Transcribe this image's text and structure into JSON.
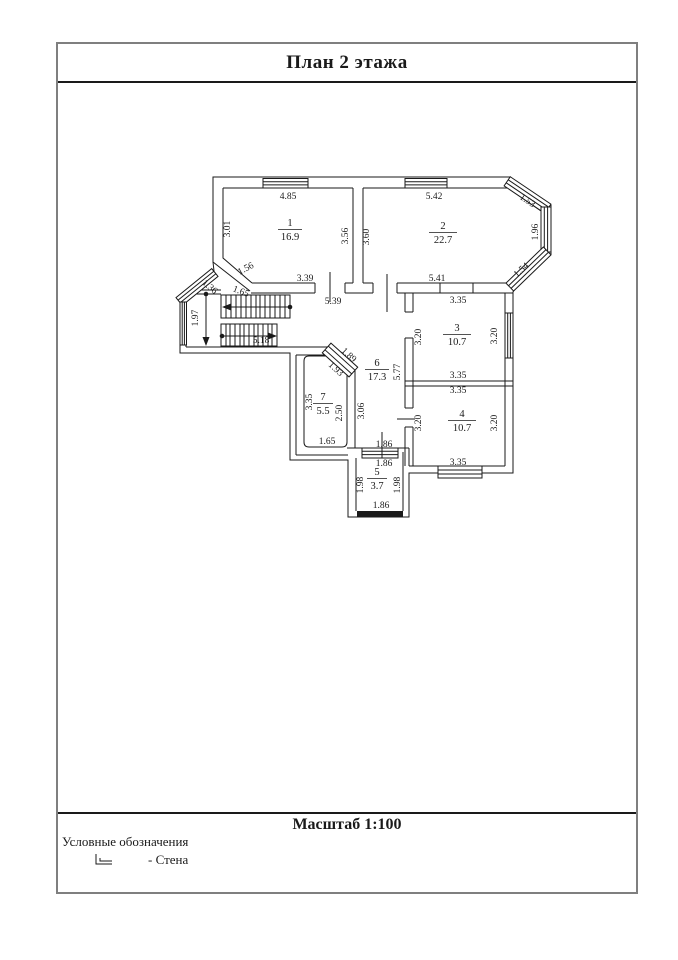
{
  "page": {
    "title": "План 2 этажа",
    "scale_label": "Масштаб 1:100",
    "legend_title": "Условные обозначения",
    "legend_wall_label": "- Стена",
    "wall_symbol_icon": "wall-corner-icon",
    "line_color": "#1a1a1a",
    "frame_color": "#7f7f7f"
  },
  "plan": {
    "rooms": [
      {
        "number": "1",
        "area": "16.9"
      },
      {
        "number": "2",
        "area": "22.7"
      },
      {
        "number": "3",
        "area": "10.7"
      },
      {
        "number": "4",
        "area": "10.7"
      },
      {
        "number": "5",
        "area": "3.7"
      },
      {
        "number": "6",
        "area": "17.3"
      },
      {
        "number": "7",
        "area": "5.5"
      }
    ],
    "dims": {
      "r1_top": "4.85",
      "r1_left": "3.01",
      "r1_right": "3.56",
      "r1_diag": "1.56",
      "r1_bottom": "3.39",
      "r2_top": "5.42",
      "r2_left": "3.60",
      "bay_top": "1.53",
      "bay_right": "1.96",
      "bay_bottom": "1.54",
      "r2_bottom": "5.41",
      "hall_top": "5.39",
      "stair_bay": "1.36",
      "stair_top": "1.65",
      "stair_width": "1.97",
      "stair_run": "5.18",
      "r3_top": "3.35",
      "r3_left": "3.20",
      "r3_right": "3.20",
      "r3_bottom": "3.35",
      "r4_top": "3.35",
      "r4_left": "3.20",
      "r4_right": "3.20",
      "r4_bottom": "3.35",
      "hall_height": "5.77",
      "hall_width": "3.06",
      "door_diag_a": "1.89",
      "door_diag_b": "1.93",
      "r7_left": "3.35",
      "r7_right": "2.50",
      "r7_bottom": "1.65",
      "r5_top_out": "1.86",
      "r5_top_in": "1.86",
      "r5_left": "1.98",
      "r5_right": "1.98",
      "r5_bottom": "1.86"
    }
  }
}
